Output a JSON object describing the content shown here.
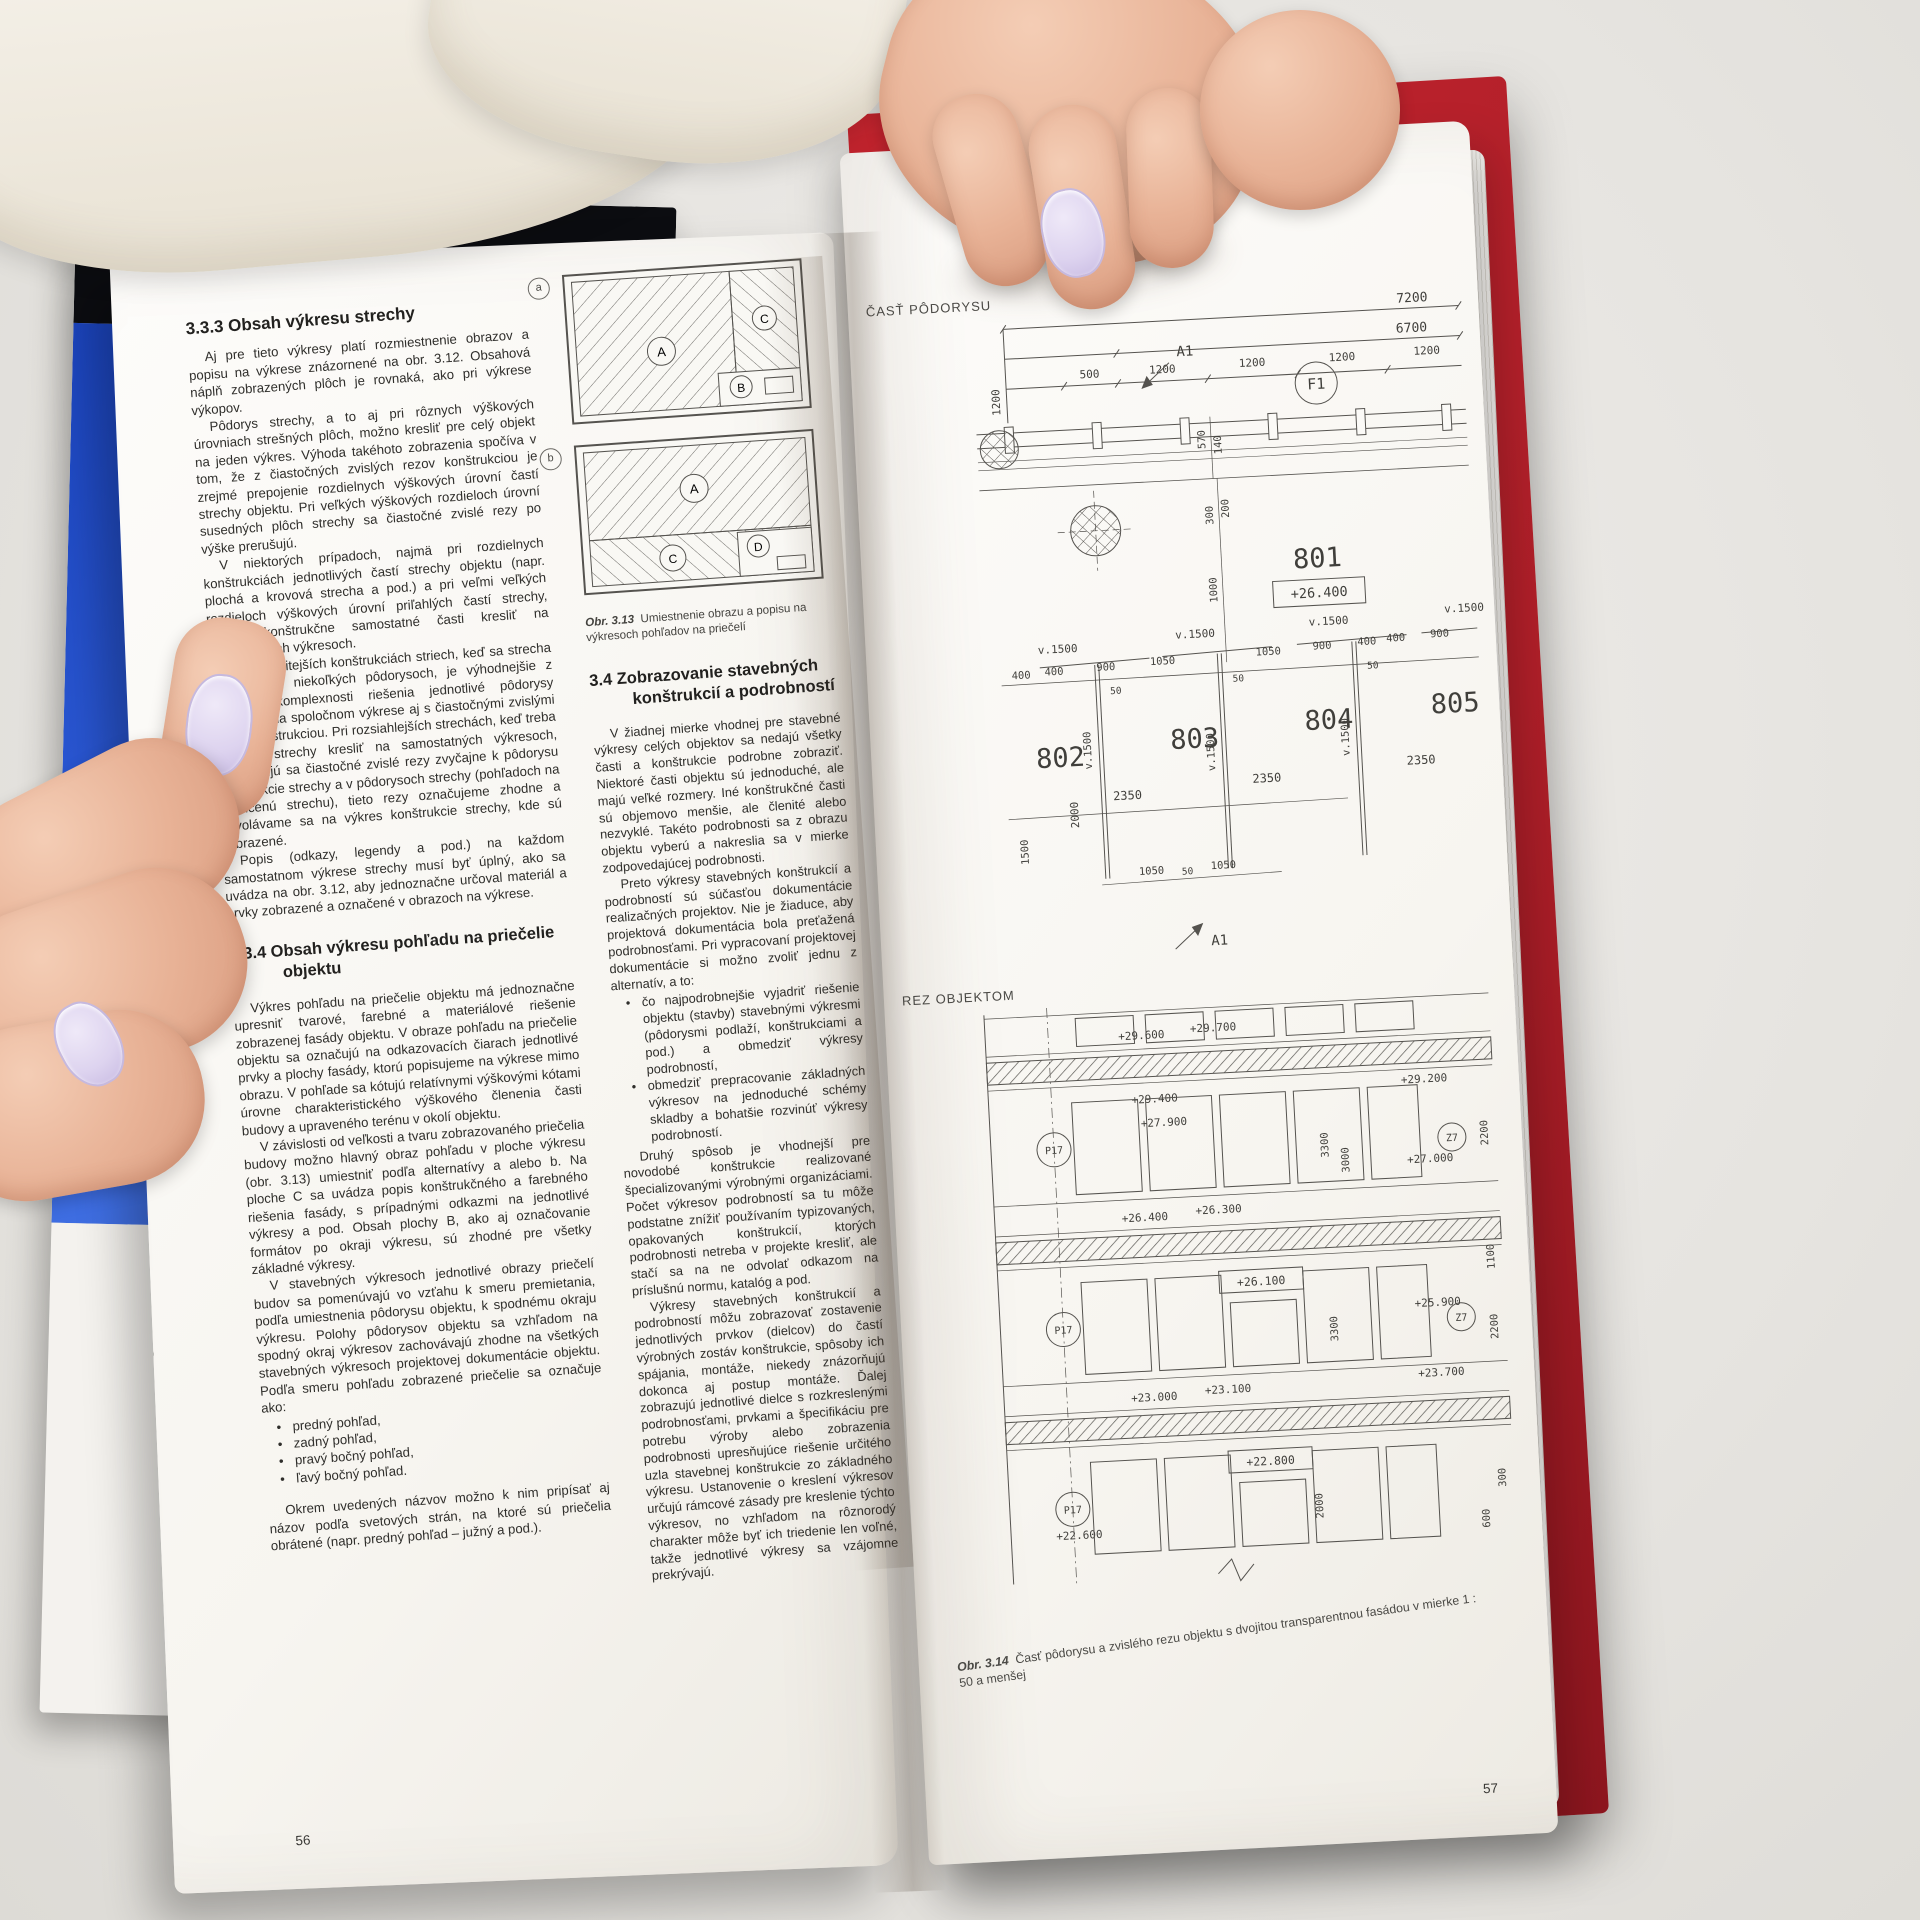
{
  "background": {
    "spine_text": "www.",
    "cover_letter": "Č",
    "cover_lines": [
      "Dopra",
      "ochran",
      "ovzdu"
    ]
  },
  "ui": {
    "bullet": "•",
    "fig_a": "a",
    "fig_b": "b"
  },
  "left_page": {
    "page_number": "56",
    "h333": "3.3.3  Obsah výkresu strechy",
    "p1": "Aj pre tieto výkresy platí rozmiestnenie obrazov a popisu na výkrese znázornené na obr. 3.12. Obsahová náplň zobrazených plôch je rovnaká, ako pri výkrese výkopov.",
    "p2": "Pôdorys strechy, a to aj pri rôznych výškových úrovniach strešných plôch, možno kresliť pre celý objekt na jeden výkres. Výhoda takéhoto zobrazenia spočíva v tom, že z čiastočných zvislých rezov konštrukciou je zrejmé prepojenie rozdielnych výškových úrovní častí strechy objektu. Pri veľkých výškových rozdieloch úrovní susedných plôch strechy sa čiastočné zvislé rezy po výške prerušujú.",
    "p3": "V niektorých prípadoch, najmä pri rozdielnych konštrukciách jednotlivých častí strechy objektu (napr. plochá a krovová strecha a pod.) a pri veľmi veľkých rozdieloch výškových úrovní priľahlých častí strechy, možno konštrukčne samostatné časti kresliť na samostatných výkresoch.",
    "p4": "Aj pri zložitejších konštrukciách striech, keď sa strecha zobrazuje v niekoľkých pôdorysoch, je výhodnejšie z hľadiska komplexnosti riešenia jednotlivé pôdorysy umiestniť na spoločnom výkrese aj s čiastočnými zvislými rezmi konštrukciou. Pri rozsiahlejších strechách, keď treba pôdorys strechy kresliť na samostatných výkresoch, umiestňujú sa čiastočné zvislé rezy zvyčajne k pôdorysu konštrukcie strechy a v pôdorysoch strechy (pohľadoch na ukončenú strechu), tieto rezy označujeme zhodne a odvolávame sa na výkres konštrukcie strechy, kde sú zobrazené.",
    "p5": "Popis (odkazy, legendy a pod.) na každom samostatnom výkrese strechy musí byť úplný, ako sa uvádza na obr. 3.12, aby jednoznačne určoval materiál a prvky zobrazené a označené v obrazoch na výkrese.",
    "h334_l1": "3.3.4  Obsah výkresu pohľadu na priečelie",
    "h334_l2": "objektu",
    "p6": "Výkres pohľadu na priečelie objektu má jednoznačne upresniť tvarové, farebné a materiálové riešenie zobrazenej fasády objektu. V obraze pohľadu na priečelie objektu sa označujú na odkazovacích čiarach jednotlivé prvky a plochy fasády, ktorú popisujeme na výkrese mimo obrazu. V pohľade sa kótujú relatívnymi výškovými kótami úrovne charakteristického výškového členenia časti budovy a upraveného terénu v okolí objektu.",
    "p7": "V závislosti od veľkosti a tvaru zobrazovaného priečelia budovy možno hlavný obraz pohľadu v ploche výkresu (obr. 3.13) umiestniť podľa alternatívy a alebo b. Na ploche C sa uvádza popis konštrukčného a farebného riešenia fasády, s prípadnými odkazmi na jednotlivé výkresy a pod. Obsah plochy B, ako aj označovanie formátov po okraji výkresu, sú zhodné pre všetky základné výkresy.",
    "p8": "V stavebných výkresoch jednotlivé obrazy priečelí budov sa pomenúvajú vo vzťahu k smeru premietania, podľa umiestnenia pôdorysu objektu, k spodnému okraju výkresu. Polohy pôdorysov objektu sa vzhľadom na spodný okraj výkresov zachovávajú zhodne na všetkých stavebných výkresoch projektovej dokumentácie objektu. Podľa smeru pohľadu zobrazené priečelie sa označuje ako:",
    "views": [
      "predný pohľad,",
      "zadný pohľad,",
      "pravý bočný pohľad,",
      "ľavý bočný pohľad."
    ],
    "p9": "Okrem uvedených názvov možno k nim pripísať aj názov podľa svetových strán, na ktoré sú priečelia obrátené (napr. predný pohľad – južný a pod.).",
    "fig": {
      "marks_a": [
        "A",
        "C",
        "B"
      ],
      "marks_b": [
        "A",
        "C",
        "D"
      ],
      "cap_num": "Obr. 3.13",
      "cap_text": "Umiestnenie obrazu a popisu na výkresoch pohľadov na priečelí"
    },
    "h34_l1": "3.4  Zobrazovanie stavebných",
    "h34_l2": "konštrukcií a podrobností",
    "mp1": "V žiadnej mierke vhodnej pre stavebné výkresy celých objektov sa nedajú všetky časti a konštrukcie podrobne zobraziť. Niektoré časti objektu sú jednoduché, ale majú veľké rozmery. Iné konštrukčné časti sú objemovo menšie, ale členité alebo nezvyklé. Takéto podrobnosti sa z obrazu objektu vyberú a nakreslia sa v mierke zodpovedajúcej podrobnosti.",
    "mp2": "Preto výkresy stavebných konštrukcií a podrobností sú súčasťou dokumentácie realizačných projektov. Nie je žiaduce, aby projektová dokumentácia bola preťažená podrobnosťami. Pri vypracovaní projektovej dokumentácie si možno zvoliť jednu z alternatív, a to:",
    "mb1": "čo najpodrobnejšie vyjadriť riešenie objektu (stavby) stavebnými výkresmi (pôdorysmi podlaží, konštrukciami a pod.) a obmedziť výkresy podrobností,",
    "mb2": "obmedziť prepracovanie základných výkresov na jednoduché schémy skladby a bohatšie rozvinúť výkresy podrobností.",
    "mp3": "Druhý spôsob je vhodnejší pre novodobé konštrukcie realizované špecializovanými výrobnými organizáciami. Počet výkresov podrobností sa tu môže podstatne znížiť používaním typizovaných, opakovaných konštrukcií, ktorých podrobnosti netreba v projekte kresliť, ale stačí sa na ne odvolať odkazom na príslušnú normu, katalóg a pod.",
    "mp4": "Výkresy stavebných konštrukcií a podrobností môžu zobrazovať zostavenie jednotlivých prvkov (dielcov) do častí výrobných zostáv konštrukcie, spôsoby ich spájania, montáže, niekedy znázorňujú dokonca aj postup montáže. Ďalej zobrazujú jednotlivé dielce s rozkreslenými podrobnosťami, prvkami a špecifikáciu pre potrebu výroby alebo zobrazenia podrobnosti upresňujúce riešenie určitého uzla stavebnej konštrukcie zo základného výkresu. Ustanovenie o kreslení výkresov určujú rámcové zásady pre kreslenie týchto výkresov, no vzhľadom na rôznorodý charakter môže byť ich triedenie len voľné, takže jednotlivé výkresy sa vzájomne prekrývajú."
  },
  "right_page": {
    "page_number": "57",
    "plan": {
      "label": "ČASŤ PÔDORYSU",
      "dim_7200": "7200",
      "dim_6700": "6700",
      "dim_500": "500",
      "dim_1200": "1200",
      "dim_570": "570",
      "dim_140": "140",
      "dim_300": "300",
      "dim_200": "200",
      "dim_1000": "1000",
      "dim_900": "900",
      "dim_1050": "1050",
      "dim_400": "400",
      "dim_50": "50",
      "dim_2350": "2350",
      "dim_2000": "2000",
      "dim_1500": "1500",
      "grid_f1": "F1",
      "mark_a1": "A1",
      "room_801": "801",
      "room_802": "802",
      "room_803": "803",
      "room_804": "804",
      "room_805": "805",
      "level_801": "+26.400",
      "v1500": "v.1500"
    },
    "section": {
      "label": "REZ OBJEKTOM",
      "p17": "P17",
      "z7": "Z7",
      "levels": [
        "+29.600",
        "+29.700",
        "+29.400",
        "+29.200",
        "+27.900",
        "+27.000",
        "+26.400",
        "+26.300",
        "+26.100",
        "+25.900",
        "+23.700",
        "+23.000",
        "+23.100",
        "+22.800",
        "+22.600"
      ],
      "dim_2200": "2200",
      "dim_1100": "1100",
      "dim_3300": "3300",
      "dim_3000": "3000",
      "dim_2000": "2000",
      "dim_600": "600",
      "dim_300": "300"
    },
    "caption_num": "Obr. 3.14",
    "caption": "Časť pôdorysu a zvislého rezu objektu s dvojitou transparentnou fasádou v mierke 1 : 50 a menšej"
  }
}
